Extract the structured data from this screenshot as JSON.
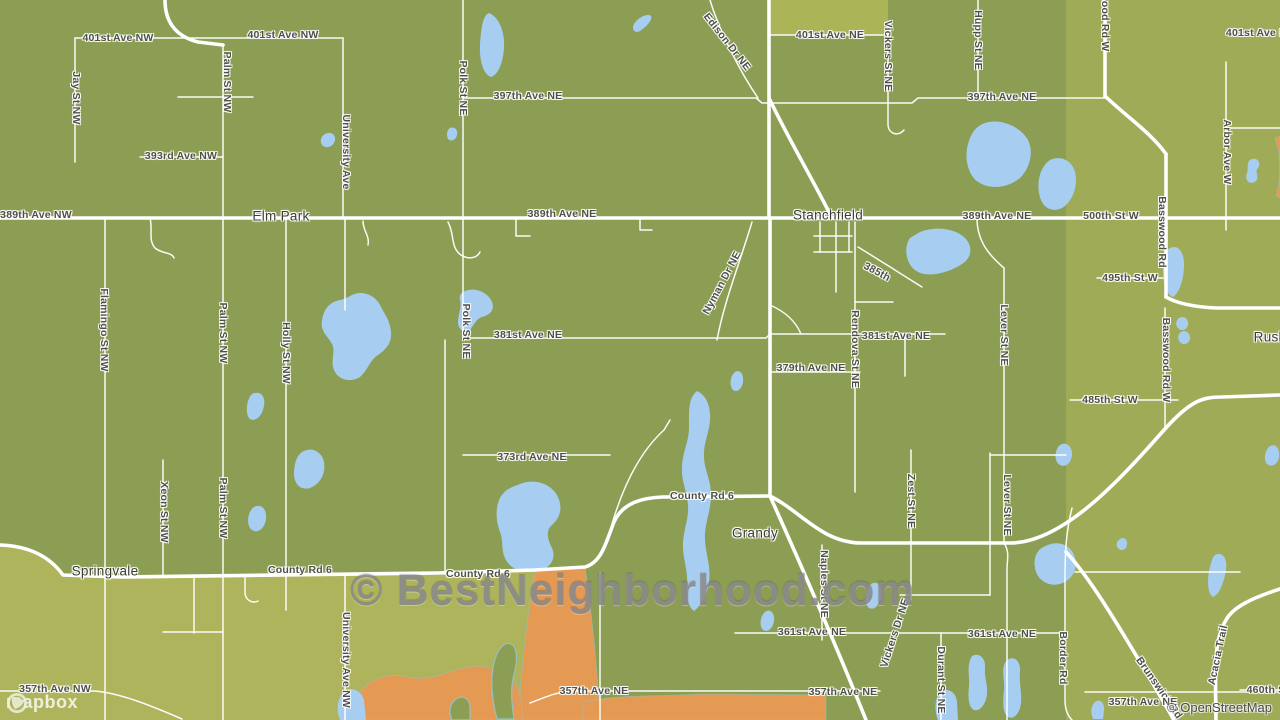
{
  "map": {
    "palette": {
      "land_base": "#8b9e53",
      "land_east": "#a0ab58",
      "land_south": "#aeb45c",
      "land_patch": "#abb457",
      "farmland_orange": "#e59a54",
      "water": "#a7cdf0",
      "road": "#ffffff",
      "label": "#4f4f49",
      "place": "#3b3b36",
      "watermark": "#8a8a8a",
      "wetland_outline": "#96c1c1"
    },
    "place_labels": [
      {
        "t": "Elm Park",
        "x": 281,
        "y": 216,
        "r": 0
      },
      {
        "t": "Stanchfield",
        "x": 828,
        "y": 215,
        "r": 0
      },
      {
        "t": "Springvale",
        "x": 105,
        "y": 571,
        "r": 0
      },
      {
        "t": "Grandy",
        "x": 755,
        "y": 533,
        "r": 0
      },
      {
        "t": "Rush",
        "x": 1270,
        "y": 337,
        "r": 0
      }
    ],
    "road_labels": [
      {
        "t": "401st Ave NW",
        "x": 118,
        "y": 38,
        "r": 0
      },
      {
        "t": "401st Ave NW",
        "x": 283,
        "y": 35,
        "r": 0
      },
      {
        "t": "Jay St NW",
        "x": 76,
        "y": 98,
        "r": 90
      },
      {
        "t": "Palm St NW",
        "x": 227,
        "y": 82,
        "r": 90
      },
      {
        "t": "393rd Ave NW",
        "x": 181,
        "y": 156,
        "r": 0
      },
      {
        "t": "University Ave",
        "x": 346,
        "y": 152,
        "r": 90
      },
      {
        "t": "Polk St NE",
        "x": 463,
        "y": 88,
        "r": 90
      },
      {
        "t": "397th Ave NE",
        "x": 528,
        "y": 96,
        "r": 0
      },
      {
        "t": "Edison Dr NE",
        "x": 727,
        "y": 42,
        "r": 52
      },
      {
        "t": "401st Ave NE",
        "x": 830,
        "y": 35,
        "r": 0
      },
      {
        "t": "Vickers St NE",
        "x": 888,
        "y": 56,
        "r": 90
      },
      {
        "t": "Hupp St NE",
        "x": 978,
        "y": 40,
        "r": 90
      },
      {
        "t": "397th Ave NE",
        "x": 1002,
        "y": 97,
        "r": 0
      },
      {
        "t": "wood Rd W",
        "x": 1105,
        "y": 22,
        "r": 90
      },
      {
        "t": "401st Ave NE",
        "x": 1260,
        "y": 33,
        "r": 0
      },
      {
        "t": "Arbor Ave W",
        "x": 1227,
        "y": 152,
        "r": 90
      },
      {
        "t": "389th Ave NW",
        "x": 36,
        "y": 215,
        "r": 0
      },
      {
        "t": "389th Ave NE",
        "x": 562,
        "y": 214,
        "r": 0
      },
      {
        "t": "389th Ave NE",
        "x": 997,
        "y": 216,
        "r": 0
      },
      {
        "t": "500th St W",
        "x": 1111,
        "y": 216,
        "r": 0
      },
      {
        "t": "Basswood Rd",
        "x": 1162,
        "y": 232,
        "r": 90
      },
      {
        "t": "495th St W",
        "x": 1130,
        "y": 278,
        "r": 0
      },
      {
        "t": "385th",
        "x": 877,
        "y": 272,
        "r": 28
      },
      {
        "t": "Rendova St NE",
        "x": 855,
        "y": 349,
        "r": 90
      },
      {
        "t": "381st Ave NE",
        "x": 528,
        "y": 335,
        "r": 0
      },
      {
        "t": "381st Ave NE",
        "x": 896,
        "y": 336,
        "r": 0
      },
      {
        "t": "379th Ave NE",
        "x": 811,
        "y": 368,
        "r": 0
      },
      {
        "t": "Nyman Dr NE",
        "x": 722,
        "y": 283,
        "r": -62
      },
      {
        "t": "Polk St NE",
        "x": 466,
        "y": 331,
        "r": 90
      },
      {
        "t": "Lever St NE",
        "x": 1004,
        "y": 335,
        "r": 90
      },
      {
        "t": "Basswood Rd W",
        "x": 1166,
        "y": 360,
        "r": 90
      },
      {
        "t": "485th St W",
        "x": 1110,
        "y": 400,
        "r": 0
      },
      {
        "t": "373rd Ave NE",
        "x": 532,
        "y": 457,
        "r": 0
      },
      {
        "t": "County Rd 6",
        "x": 702,
        "y": 496,
        "r": 0
      },
      {
        "t": "Zest St NE",
        "x": 911,
        "y": 501,
        "r": 90
      },
      {
        "t": "Lever St NE",
        "x": 1007,
        "y": 505,
        "r": 90
      },
      {
        "t": "County Rd 6",
        "x": 300,
        "y": 570,
        "r": 0
      },
      {
        "t": "County Rd 6",
        "x": 478,
        "y": 574,
        "r": 0
      },
      {
        "t": "Naples St NE",
        "x": 824,
        "y": 584,
        "r": 90
      },
      {
        "t": "361st Ave NE",
        "x": 812,
        "y": 632,
        "r": 0
      },
      {
        "t": "361st Ave NE",
        "x": 1002,
        "y": 634,
        "r": 0
      },
      {
        "t": "Vickers Dr NE",
        "x": 895,
        "y": 633,
        "r": -72
      },
      {
        "t": "Durant St NE",
        "x": 941,
        "y": 680,
        "r": 90
      },
      {
        "t": "Border Rd",
        "x": 1063,
        "y": 658,
        "r": 90
      },
      {
        "t": "Brunswick Rd",
        "x": 1159,
        "y": 688,
        "r": 55
      },
      {
        "t": "Acacia Trail",
        "x": 1218,
        "y": 655,
        "r": -78
      },
      {
        "t": "460th S",
        "x": 1266,
        "y": 690,
        "r": 0
      },
      {
        "t": "357th Ave NW",
        "x": 55,
        "y": 689,
        "r": 0
      },
      {
        "t": "357th Ave NE",
        "x": 594,
        "y": 691,
        "r": 0
      },
      {
        "t": "357th Ave NE",
        "x": 843,
        "y": 692,
        "r": 0
      },
      {
        "t": "357th Ave NE",
        "x": 1143,
        "y": 702,
        "r": 0
      },
      {
        "t": "University Ave NW",
        "x": 346,
        "y": 660,
        "r": 90
      },
      {
        "t": "Xeon St NW",
        "x": 164,
        "y": 512,
        "r": 90
      },
      {
        "t": "Palm St NW",
        "x": 223,
        "y": 333,
        "r": 90
      },
      {
        "t": "Palm St NW",
        "x": 223,
        "y": 508,
        "r": 90
      },
      {
        "t": "Flamingo St NW",
        "x": 104,
        "y": 330,
        "r": 90
      },
      {
        "t": "Holly St NW",
        "x": 286,
        "y": 353,
        "r": 90
      }
    ]
  },
  "watermark": {
    "text": "© BestNeighborhood.com"
  },
  "attribution": {
    "mapbox": "mapbox",
    "osm": "© OpenStreetMap"
  }
}
